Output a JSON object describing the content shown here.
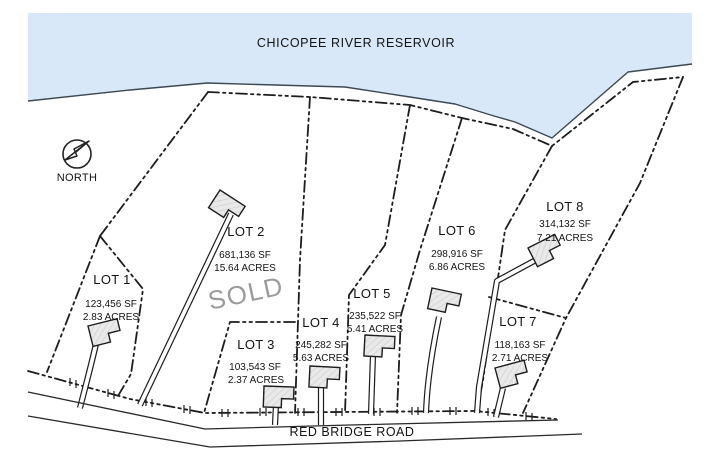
{
  "map": {
    "title": "CHICOPEE RIVER RESERVOIR",
    "road_name": "RED BRIDGE ROAD",
    "north_label": "NORTH",
    "colors": {
      "water": "#d9e8f8",
      "line": "#1d1d1d",
      "sold": "#9b9b9b"
    },
    "lots": [
      {
        "name": "LOT 1",
        "sf": "123,456 SF",
        "acres": "2.83 ACRES"
      },
      {
        "name": "LOT 2",
        "sf": "681,136 SF",
        "acres": "15.64 ACRES",
        "status": "SOLD"
      },
      {
        "name": "LOT 3",
        "sf": "103,543 SF",
        "acres": "2.37 ACRES"
      },
      {
        "name": "LOT 4",
        "sf": "245,282 SF",
        "acres": "5.63 ACRES"
      },
      {
        "name": "LOT 5",
        "sf": "235,522 SF",
        "acres": "5.41 ACRES"
      },
      {
        "name": "LOT 6",
        "sf": "298,916 SF",
        "acres": "6.86 ACRES"
      },
      {
        "name": "LOT 7",
        "sf": "118,163 SF",
        "acres": "2.71 ACRES"
      },
      {
        "name": "LOT 8",
        "sf": "314,132 SF",
        "acres": "7.21 ACRES"
      }
    ]
  }
}
